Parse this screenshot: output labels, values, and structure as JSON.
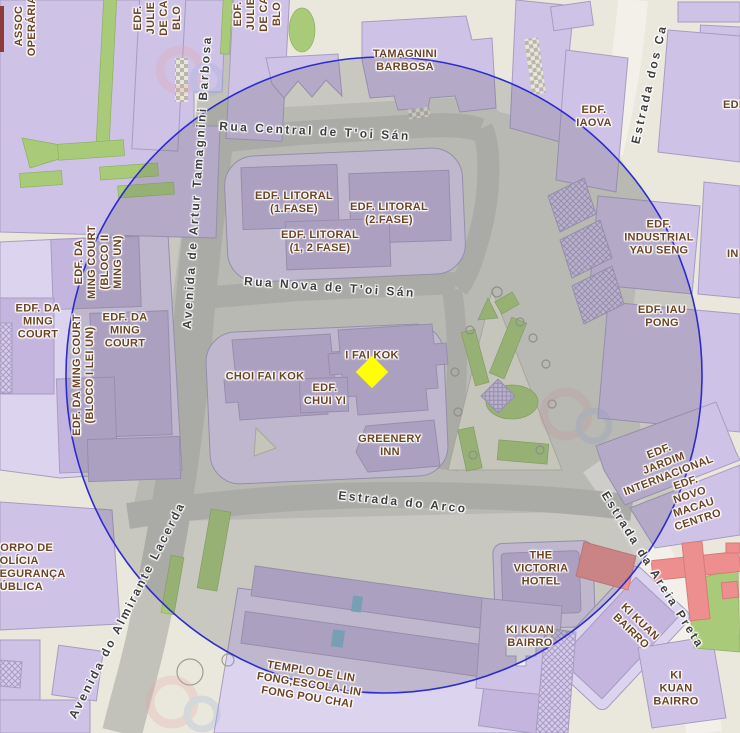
{
  "palette": {
    "bg": "#eae8dd",
    "plaza": "#d6d6cd",
    "road": "#c2c2ba",
    "road-light": "#f2f0e8",
    "platform": "#dcd3ef",
    "bldg": "#cfc2e7",
    "bldg-dark": "#c4b5de",
    "bldg-stroke": "#a79dc0",
    "park": "#e7e6d6",
    "green": "#a9cb79",
    "red": "#ee8f8f",
    "red-stroke": "#d87a7a",
    "street-label": "#3e3e3e",
    "bldg-label": "#6b4423",
    "circle-stroke": "#2b2bd0",
    "circle-fill": "rgba(100,100,108,0.25)",
    "marker": "#ffff00"
  },
  "streets": {
    "rua_central": "Rua Central de T'oi Sán",
    "rua_nova": "Rua Nova de T'oi Sán",
    "estrada_arco": "Estrada do Arco",
    "av_tamagnini": "Avenida de Artur Tamagnini Barbosa",
    "av_lacerda": "Avenida do Almirante Lacerda",
    "estrada_dos_ca": "Estrada dos Ca",
    "estrada_areia": "Estrada da Areia Preta"
  },
  "buildings": {
    "tamagnini": "TAMAGNINI\nBARBOSA",
    "litoral_1": "EDF. LITORAL\n(1.FASE)",
    "litoral_2": "EDF. LITORAL\n(2.FASE)",
    "litoral_12": "EDF. LITORAL\n(1, 2 FASE)",
    "iaova": "EDF.\nIAOVA",
    "industrial": "EDF.\nINDUSTRIAL\nYAU SENG",
    "iau_pong": "EDF. IAU\nPONG",
    "da_ming_blocoii": "EDF. DA\nMING COURT\n(BLOCO II\nMING UN)",
    "da_ming_left": "EDF. DA\nMING\nCOURT",
    "da_ming_right": "EDF. DA\nMING\nCOURT",
    "da_ming_blocoi": "EDF. DA MING COURT\n(BLOCO I LEI UN)",
    "choi_fai_kok": "CHOI FAI KOK",
    "i_fai_kok": "I FAI KOK",
    "chui_yi": "EDF.\nCHUI YI",
    "greenery_inn": "GREENERY\nINN",
    "victoria": "THE\nVICTORIA\nHOTEL",
    "ki_kuan_1": "KI KUAN\nBAIRRO",
    "ki_kuan_2": "KI KUAN\nBAIRRO",
    "ki_kuan_3": "KI\nKUAN\nBAIRRO",
    "jardim": "EDF.\nJARDIM\nINTERNACIONAL",
    "novo_macau": "EDF. NOVO\nMACAU\nCENTRO",
    "templo": "TEMPLO DE LIN\nFONG,ESCOLA LIN\nFONG POU CHAI",
    "corpo_policia": "CORPO DE\nPOLÍCIA\nSEGURANÇA\nPÚBLICA",
    "assoc_operaria": "ASSOC\nOPERÁRIA",
    "julieta_1": "EDF.\nJULIE\nDE CA\nBLO",
    "julieta_2": "EDF.\nJULIE\nDE CA\nBLO",
    "edf_cut": "EDF.",
    "in_cut": "IN"
  },
  "overlay": {
    "buffer_circle": {
      "cx": 384,
      "cy": 375,
      "r": 318
    },
    "marker": {
      "x": 372,
      "y": 372
    }
  }
}
